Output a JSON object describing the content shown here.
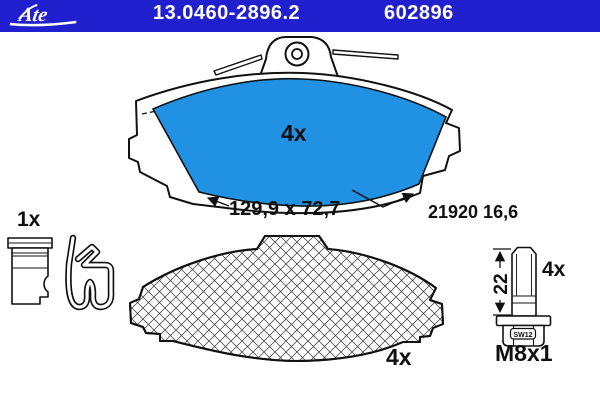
{
  "header": {
    "brand": "Ate",
    "part_number": "13.0460-2896.2",
    "reference": "602896",
    "bar_color": "#2020cf"
  },
  "colors": {
    "friction_blue": "#2191e4",
    "line_black": "#111111"
  },
  "friction_pad_view": {
    "quantity": "4x",
    "dimensions": "129,9 x 72,7",
    "wva_number": "21920 16,6"
  },
  "accessory_kit": {
    "quantity": "1x"
  },
  "backplate_view": {
    "quantity": "4x"
  },
  "bolt_view": {
    "length": "22",
    "quantity": "4x",
    "wrench_size": "SW12",
    "thread": "M8x1"
  }
}
